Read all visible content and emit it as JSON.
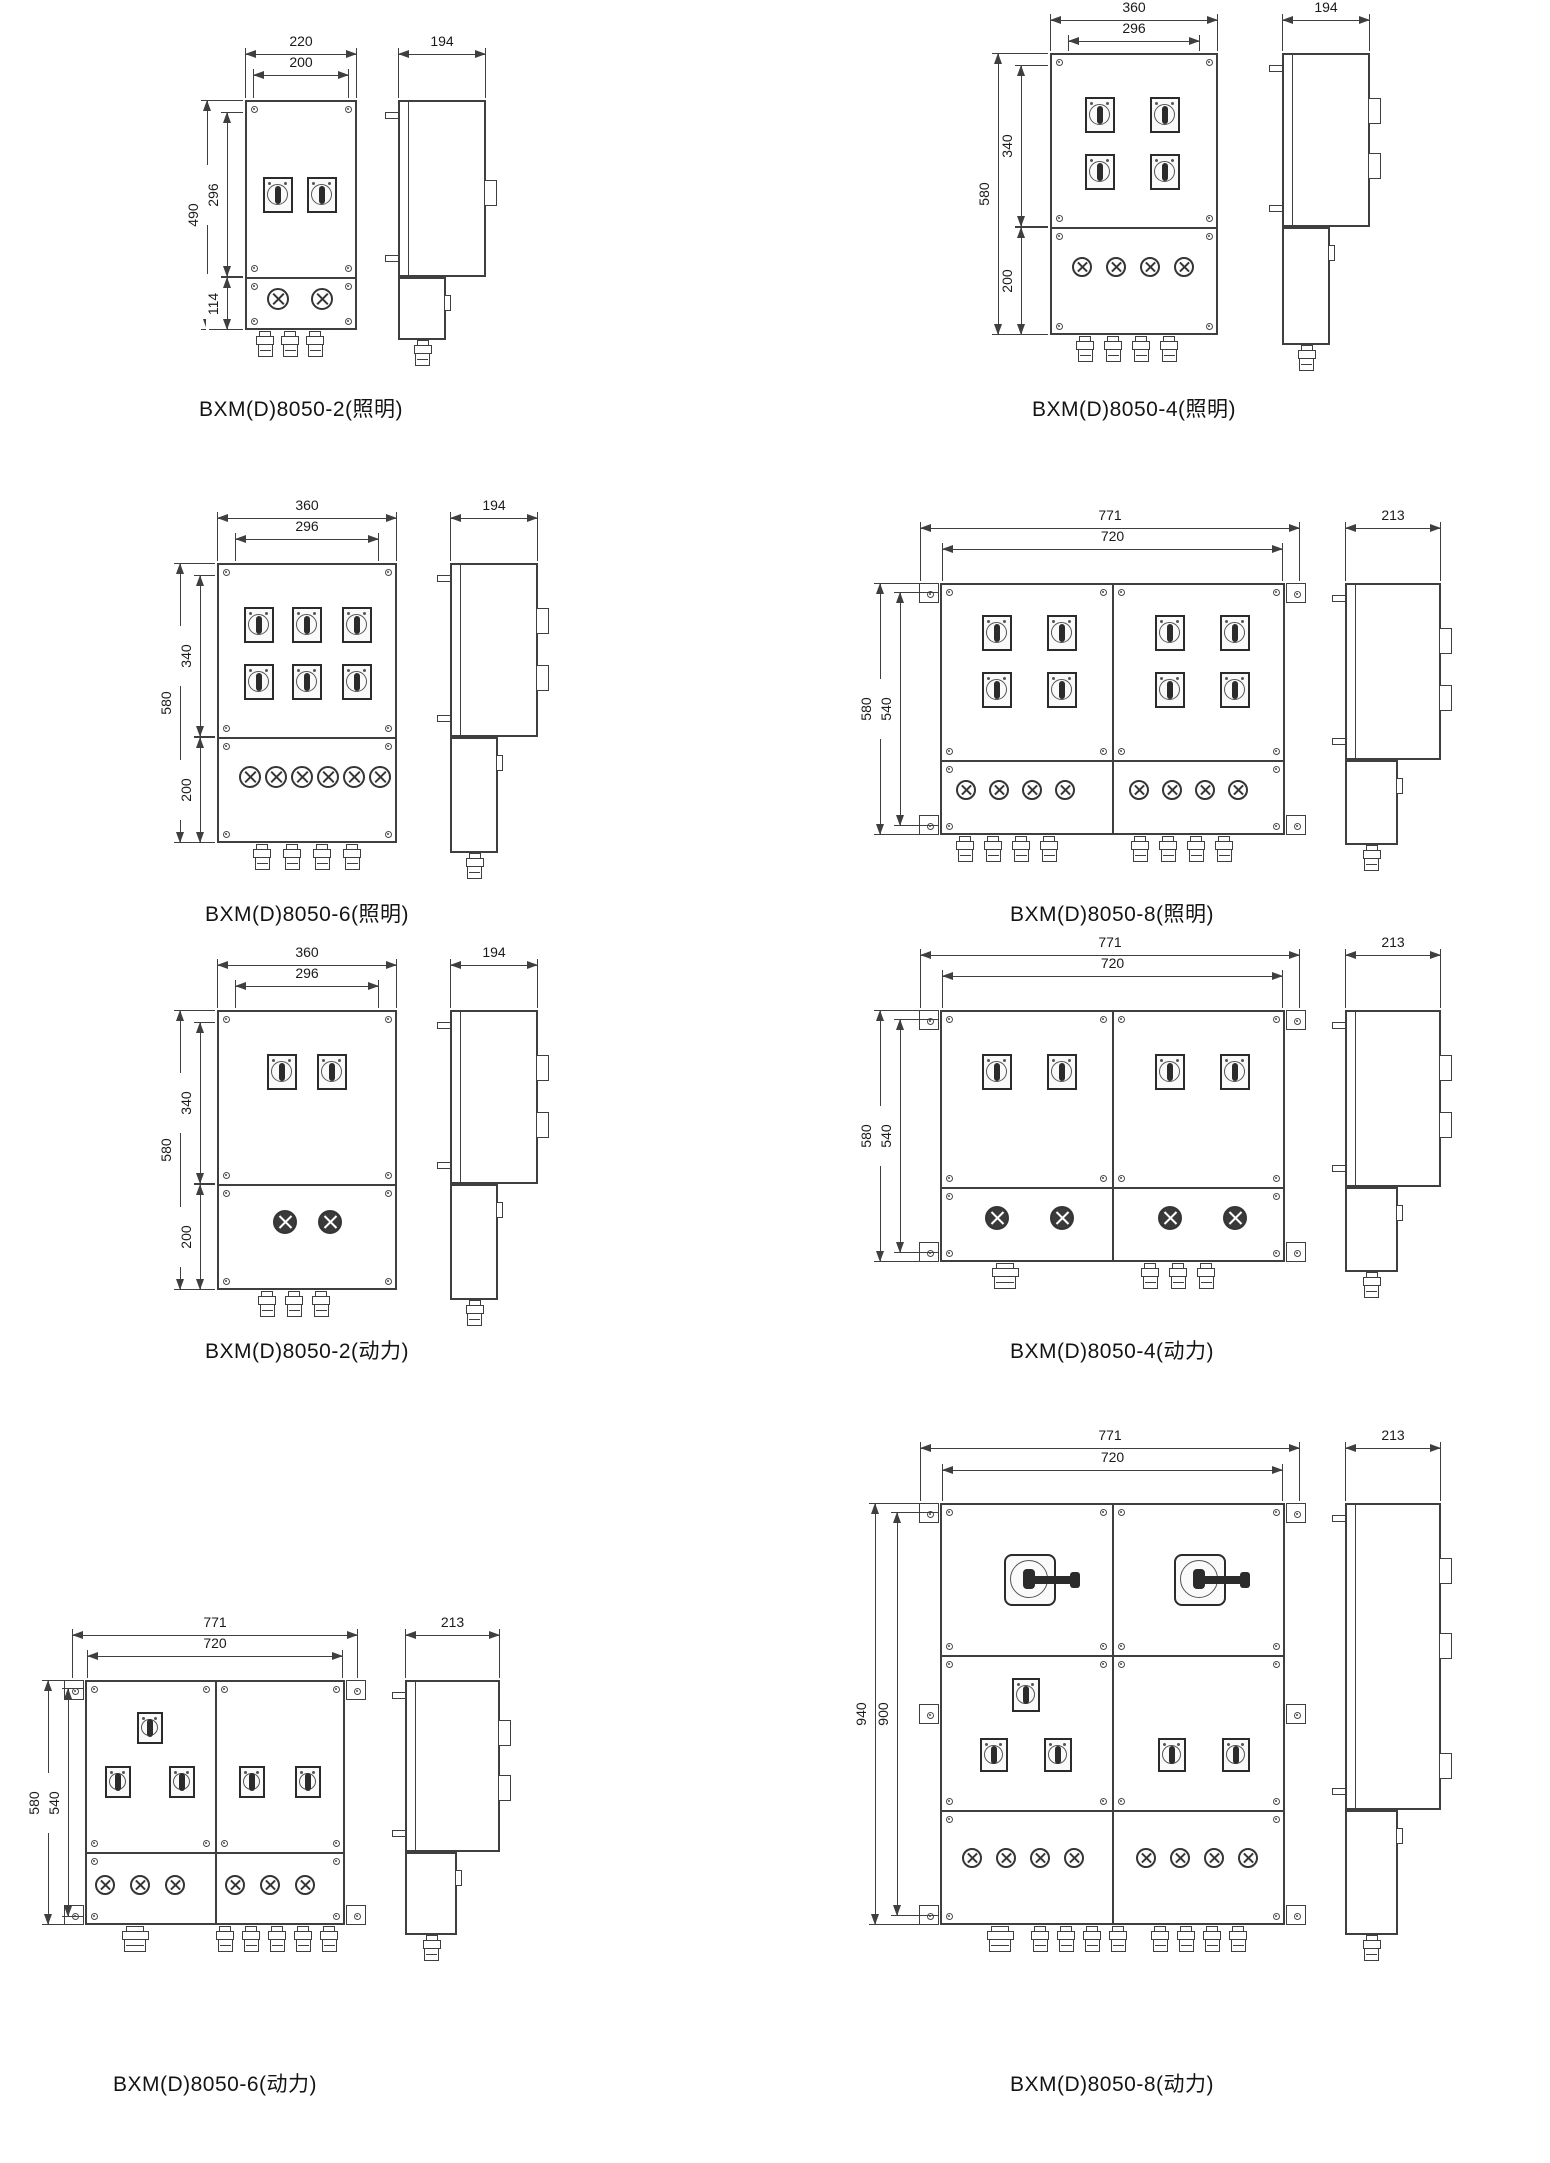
{
  "page": {
    "background": "#ffffff",
    "line_color": "#3f3f3f",
    "text_color": "#1a1a1a",
    "series": "BXM(D)8050"
  },
  "diagrams": [
    {
      "caption": "BXM(D)8050-2(照明)",
      "variant": "照明",
      "front": {
        "width_dims": [
          "220",
          "200"
        ],
        "height_dims": [
          "490",
          "296",
          "114"
        ],
        "panel_count": 1,
        "switch_count": 2,
        "indicator_type": "indicator-lamp",
        "indicator_count": 2,
        "gland_small_count": 3,
        "gland_large_count": 0
      },
      "side": {
        "width_dim": "194",
        "junction_count": 1
      }
    },
    {
      "caption": "BXM(D)8050-4(照明)",
      "variant": "照明",
      "front": {
        "width_dims": [
          "360",
          "296"
        ],
        "height_dims": [
          "580",
          "340",
          "200"
        ],
        "panel_count": 1,
        "switch_count": 4,
        "indicator_type": "indicator-lamp",
        "indicator_count": 4,
        "gland_small_count": 4,
        "gland_large_count": 0
      },
      "side": {
        "width_dim": "194",
        "junction_count": 2
      }
    },
    {
      "caption": "BXM(D)8050-6(照明)",
      "variant": "照明",
      "front": {
        "width_dims": [
          "360",
          "296"
        ],
        "height_dims": [
          "580",
          "340",
          "200"
        ],
        "panel_count": 1,
        "switch_count": 6,
        "indicator_type": "indicator-lamp",
        "indicator_count": 6,
        "gland_small_count": 4,
        "gland_large_count": 0
      },
      "side": {
        "width_dim": "194",
        "junction_count": 2
      }
    },
    {
      "caption": "BXM(D)8050-8(照明)",
      "variant": "照明",
      "front": {
        "width_dims": [
          "771",
          "720"
        ],
        "height_dims": [
          "580",
          "540"
        ],
        "panel_count": 2,
        "switch_count": 8,
        "indicator_type": "indicator-lamp",
        "indicator_count": 8,
        "gland_small_count": 8,
        "gland_large_count": 0
      },
      "side": {
        "width_dim": "213",
        "junction_count": 2
      }
    },
    {
      "caption": "BXM(D)8050-2(动力)",
      "variant": "动力",
      "front": {
        "width_dims": [
          "360",
          "296"
        ],
        "height_dims": [
          "580",
          "340",
          "200"
        ],
        "panel_count": 1,
        "switch_count": 2,
        "indicator_type": "pushbutton",
        "indicator_count": 2,
        "gland_small_count": 3,
        "gland_large_count": 0
      },
      "side": {
        "width_dim": "194",
        "junction_count": 2
      }
    },
    {
      "caption": "BXM(D)8050-4(动力)",
      "variant": "动力",
      "front": {
        "width_dims": [
          "771",
          "720"
        ],
        "height_dims": [
          "580",
          "540"
        ],
        "panel_count": 2,
        "switch_count": 4,
        "indicator_type": "pushbutton",
        "indicator_count": 4,
        "gland_small_count": 3,
        "gland_large_count": 1
      },
      "side": {
        "width_dim": "213",
        "junction_count": 2
      }
    },
    {
      "caption": "BXM(D)8050-6(动力)",
      "variant": "动力",
      "front": {
        "width_dims": [
          "771",
          "720"
        ],
        "height_dims": [
          "580",
          "540"
        ],
        "panel_count": 2,
        "switch_count": 5,
        "indicator_type": "indicator-lamp",
        "indicator_count": 6,
        "gland_small_count": 5,
        "gland_large_count": 1
      },
      "side": {
        "width_dim": "213",
        "junction_count": 2
      }
    },
    {
      "caption": "BXM(D)8050-8(动力)",
      "variant": "动力",
      "front": {
        "width_dims": [
          "771",
          "720"
        ],
        "height_dims": [
          "940",
          "900"
        ],
        "panel_count": 4,
        "main_handle_count": 2,
        "switch_count": 5,
        "indicator_type": "indicator-lamp",
        "indicator_count": 8,
        "gland_small_count": 8,
        "gland_large_count": 1
      },
      "side": {
        "width_dim": "213",
        "junction_count": 3
      }
    }
  ]
}
